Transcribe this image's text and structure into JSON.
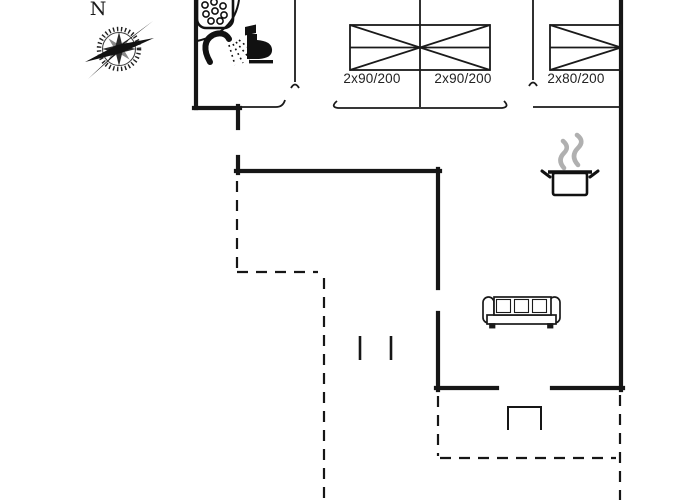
{
  "plan": {
    "type": "holiday-house-floor-plan",
    "compass_label": "N",
    "bed_labels": [
      "2x90/200",
      "2x90/200",
      "2x80/200"
    ],
    "icons": [
      "compass-rose-icon",
      "shower-tray-icon",
      "shower-head-icon",
      "toilet-icon",
      "cooking-pot-icon",
      "steam-icon",
      "sofa-icon",
      "entrance-step-icon",
      "double-bed-icon",
      "single-wide-bed-icon"
    ],
    "colors": {
      "line": "#161616",
      "steam": "#b0b0b0",
      "background": "#ffffff"
    }
  }
}
